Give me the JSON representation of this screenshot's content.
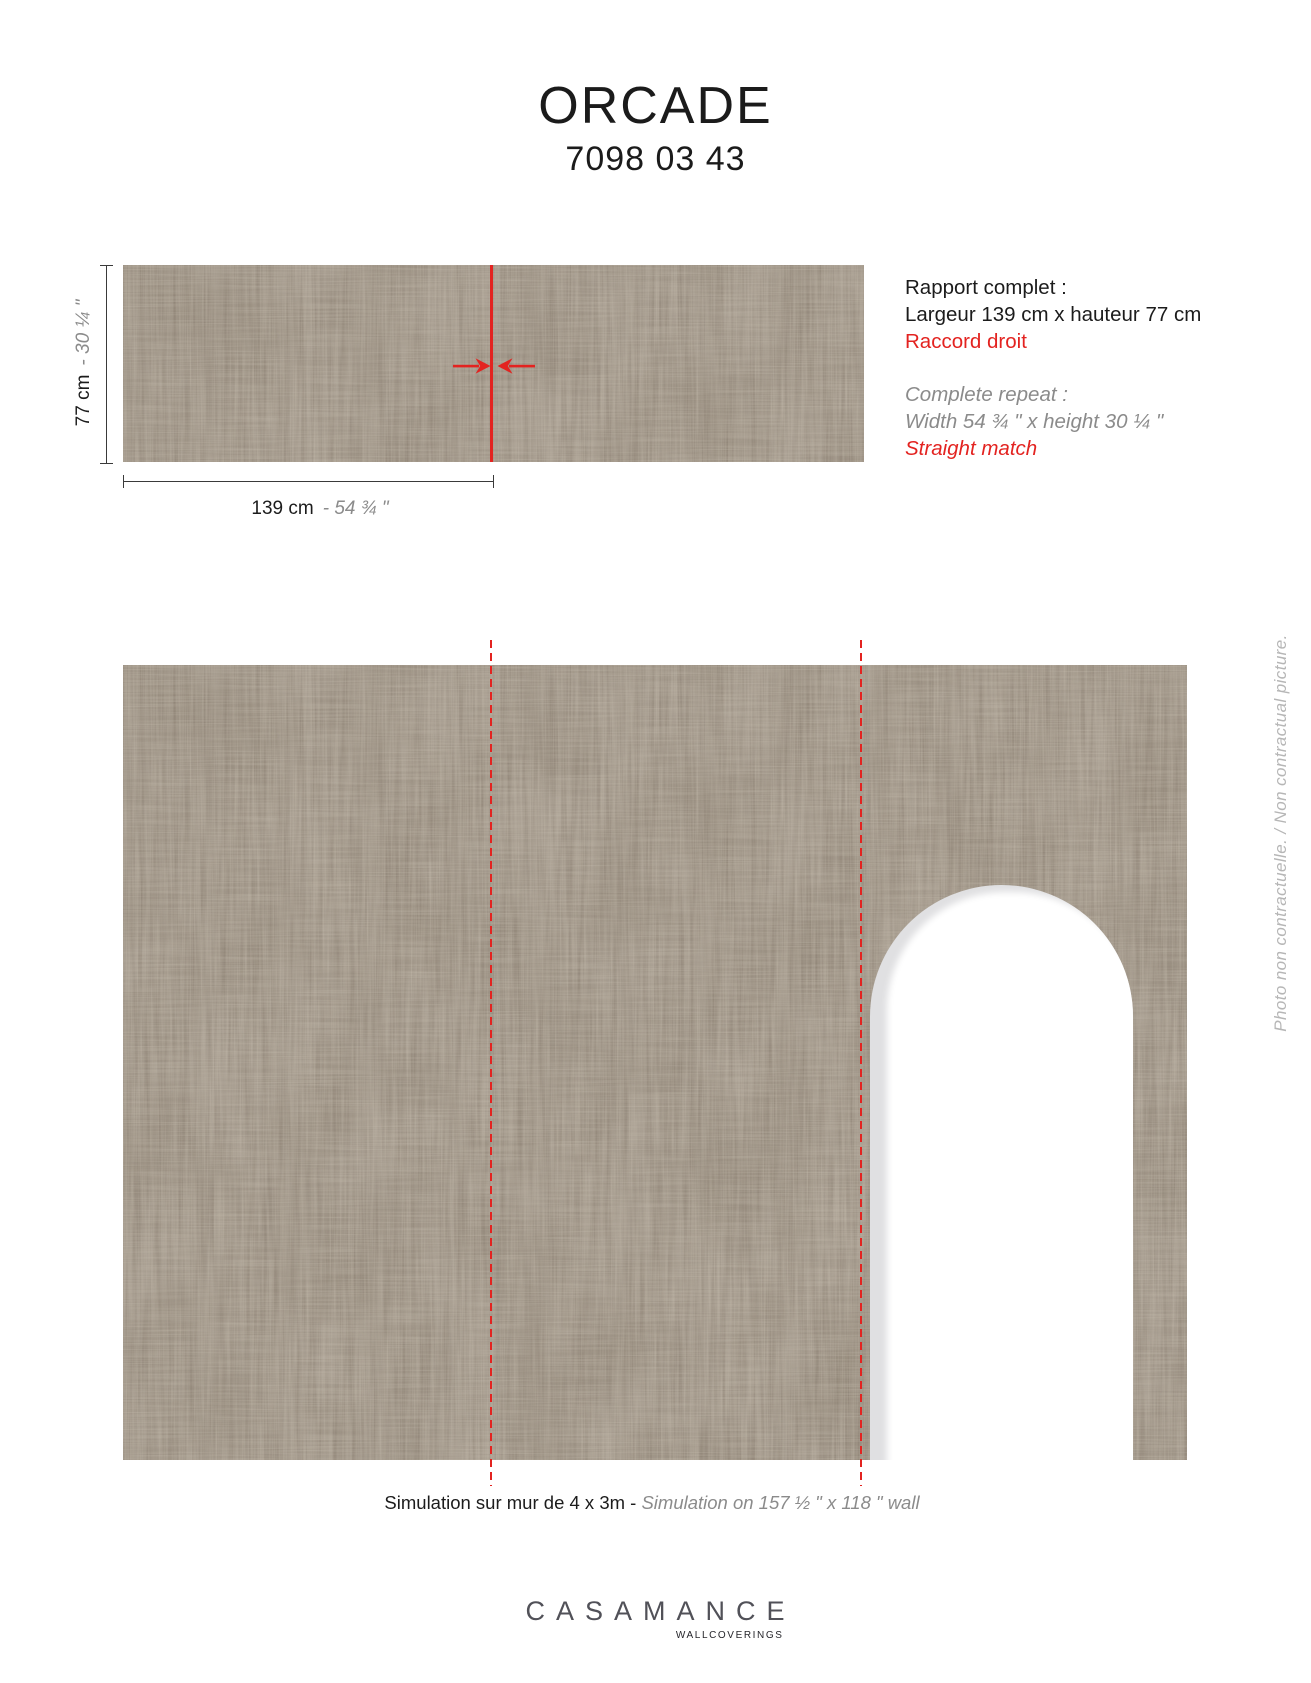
{
  "header": {
    "title": "ORCADE",
    "code": "7098 03 43"
  },
  "repeat_diagram": {
    "width_cm": "139 cm",
    "width_in": "- 54 ¾ \"",
    "height_cm": "77 cm",
    "height_in": "- 30 ¼ \""
  },
  "specs": {
    "fr": {
      "line1": "Rapport complet :",
      "line2": "Largeur 139 cm x hauteur 77 cm",
      "line3": "Raccord droit"
    },
    "en": {
      "line1": "Complete repeat :",
      "line2": "Width 54 ¾ \" x height 30 ¼ \"",
      "line3": "Straight match"
    }
  },
  "simulation": {
    "caption_fr": "Simulation sur mur de 4 x 3m - ",
    "caption_en": "Simulation on 157 ½ \" x 118 \" wall",
    "side_note": "Photo non contractuelle. / Non contractual picture."
  },
  "footer": {
    "brand": "CASAMANCE",
    "tagline": "WALLCOVERINGS"
  },
  "colors": {
    "accent_red": "#e32320",
    "wallpaper_base": "#a89e91",
    "wallpaper_dark": "#8b8071",
    "secondary_gray_text": "#8b8b8b",
    "side_note_gray": "#b6b6b6",
    "logo_gray": "#515158"
  }
}
